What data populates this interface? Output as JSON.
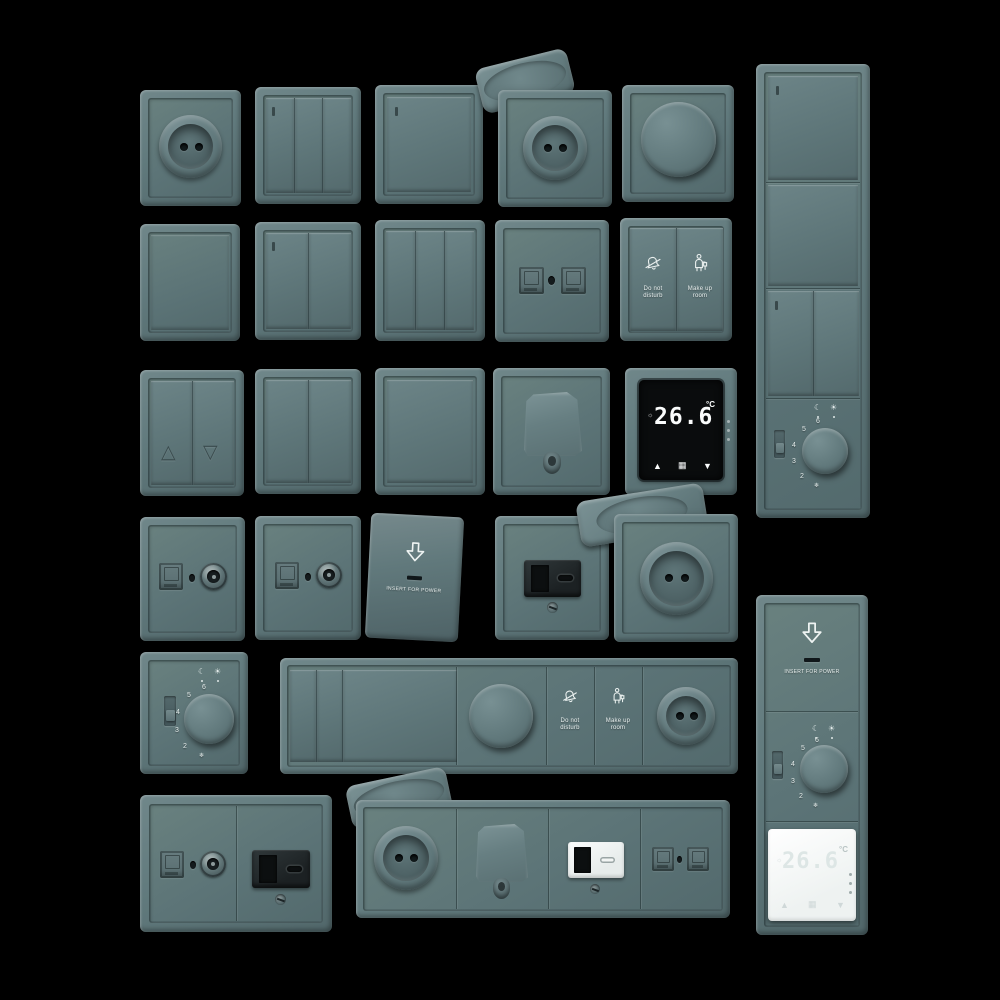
{
  "scene": {
    "description": "3D render of a matte slate-teal wall switch and socket series on a black background",
    "background": "#000000"
  },
  "palette": {
    "plate": "#617a7d",
    "plate_light": "#7b9294",
    "plate_dark": "#4a5e61",
    "module_dark": "#24292b",
    "module_white": "#f2f5f4",
    "screen_black": "#0a0c0d",
    "digit_white": "#fafcfc",
    "digit_soft": "#dde6e5",
    "label_white": "#e9efee"
  },
  "glyphs": {
    "arrow_up": "▲",
    "arrow_down": "▼",
    "menu_grid": "▦",
    "shutter_up": "△",
    "shutter_down": "▽",
    "moon": "☾",
    "sun": "☀",
    "snowflake": "❄",
    "flame_indicator": "☼"
  },
  "labels": {
    "do_not_line1": "Do not",
    "do_not_line2": "disturb",
    "make_up_line1": "Make up",
    "make_up_line2": "room",
    "insert_for_power": "INSERT FOR POWER",
    "temperature": "26.6",
    "temp_unit": "°C"
  },
  "dial": {
    "m2": "2",
    "m3": "3",
    "m4": "4",
    "m5": "5",
    "m6": "6"
  },
  "inventory": {
    "row1": [
      "euro socket",
      "3-gang switch",
      "1-gang switch",
      "lidded socket (lid open)",
      "rotary dimmer"
    ],
    "row2": [
      "blank plate",
      "2-gang switch",
      "3-gang switch",
      "dual data socket",
      "do-not-disturb / make-up-room switch"
    ],
    "row3": [
      "shutter switch",
      "2-gang switch",
      "1-gang switch",
      "cable outlet",
      "digital thermostat 26.6°C"
    ],
    "row4": [
      "TV socket",
      "data + coax socket",
      "key card switch",
      "USB A+C socket",
      "lidded socket (lid open)"
    ],
    "row5": [
      "analog dial thermostat",
      "6-gang strip: switches, dimmer, hotel buttons, socket"
    ],
    "row6": [
      "TV + USB combo plate",
      "4-gang strip: lidded socket, cable outlet, white USB, data",
      "vertical strip: key card, dial thermostat, white digital thermostat"
    ],
    "right_column": [
      "vertical 4-module strip: switches and dial thermostat"
    ]
  }
}
